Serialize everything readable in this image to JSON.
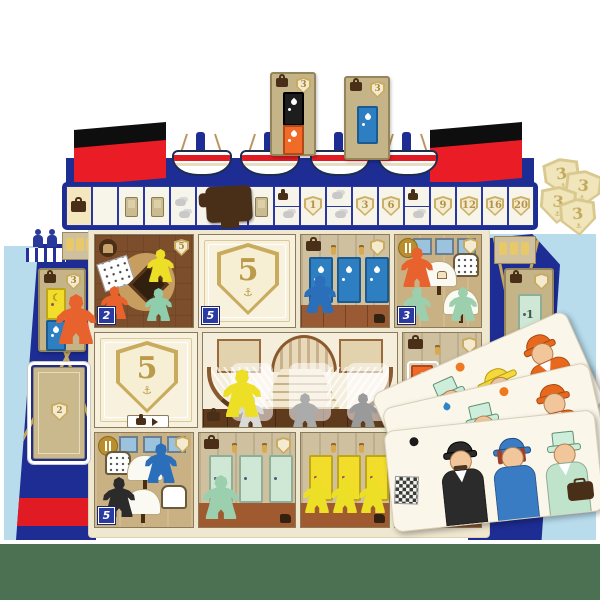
{
  "palette": {
    "navy": "#1d2d94",
    "sky_blue": "#b8dcec",
    "hull_red": "#e11b24",
    "cream": "#f7f1de",
    "tan_card": "#c5b488",
    "gold": "#c9ab5e",
    "table_green": "#4c7052",
    "meeple_colors": [
      "orange",
      "yellow",
      "teal",
      "blue",
      "green",
      "black",
      "gray",
      "white"
    ]
  },
  "icons": {
    "anchor": "⚓",
    "moon": "☾"
  },
  "ship_board": {
    "funnel_count": 2,
    "lifeboat_count": 4,
    "marker": "brown-suitcase-pawn",
    "track_cells": [
      {
        "type": "start"
      },
      {
        "type": "blank"
      },
      {
        "type": "card"
      },
      {
        "type": "card"
      },
      {
        "type": "smoke"
      },
      {
        "type": "blank"
      },
      {
        "type": "split"
      },
      {
        "type": "card"
      },
      {
        "type": "split"
      },
      {
        "type": "shield",
        "value": "1"
      },
      {
        "type": "split"
      },
      {
        "type": "shield",
        "value": "3"
      },
      {
        "type": "shield",
        "value": "6"
      },
      {
        "type": "split"
      },
      {
        "type": "shield",
        "value": "9"
      },
      {
        "type": "shield",
        "value": "12"
      },
      {
        "type": "shield",
        "value": "16"
      },
      {
        "type": "shield",
        "value": "20"
      }
    ]
  },
  "top_cards": [
    {
      "shield": "3",
      "doors": [
        "black",
        "orange"
      ]
    },
    {
      "shield": "3",
      "doors": [
        "blue"
      ]
    }
  ],
  "coins": {
    "value": "3",
    "count": 4
  },
  "board": {
    "left_card": {
      "shield": "3",
      "doors": [
        "yellow",
        "blue"
      ]
    },
    "left_slot_card": {
      "value": "2"
    },
    "right_card": {
      "door": "green",
      "door_label": "1"
    },
    "rooms": {
      "lounge": {
        "corner_shield": "5",
        "badge": "2",
        "meeples": [
          "yellow",
          "orange",
          "teal"
        ]
      },
      "promenade_top": {
        "shield": "5",
        "badge": "5"
      },
      "cabin_blue": {
        "meeples": [
          "blue"
        ]
      },
      "dining_top": {
        "badge": "3",
        "meeples": [
          "orange",
          "green",
          "green"
        ]
      },
      "promenade_mid": {
        "shield": "5"
      },
      "staircase": {
        "meeples": [
          "yellow",
          "white",
          "gray",
          "gray"
        ]
      },
      "cabin_orange": {},
      "dining_bottom": {
        "badge": "5",
        "meeples": [
          "blue",
          "black"
        ]
      },
      "cabin_green": {
        "meeples": [
          "green"
        ]
      },
      "cabin_yellow": {
        "meeples": [
          "yellow",
          "yellow",
          "yellow"
        ]
      },
      "room_four": {
        "badge": "4"
      }
    }
  },
  "passenger_cards": [
    {
      "dot": "orange",
      "passengers": [
        "mint-tophat-man",
        "yellow-dress-lady",
        "orange-coat-man"
      ]
    },
    {
      "dot": "orange",
      "passengers": [
        "mint-tophat-man",
        "orange-coat-man"
      ]
    },
    {
      "dot": "black",
      "passengers": [
        "black-suit-man",
        "blue-dress-lady",
        "mint-coat-person"
      ]
    }
  ]
}
